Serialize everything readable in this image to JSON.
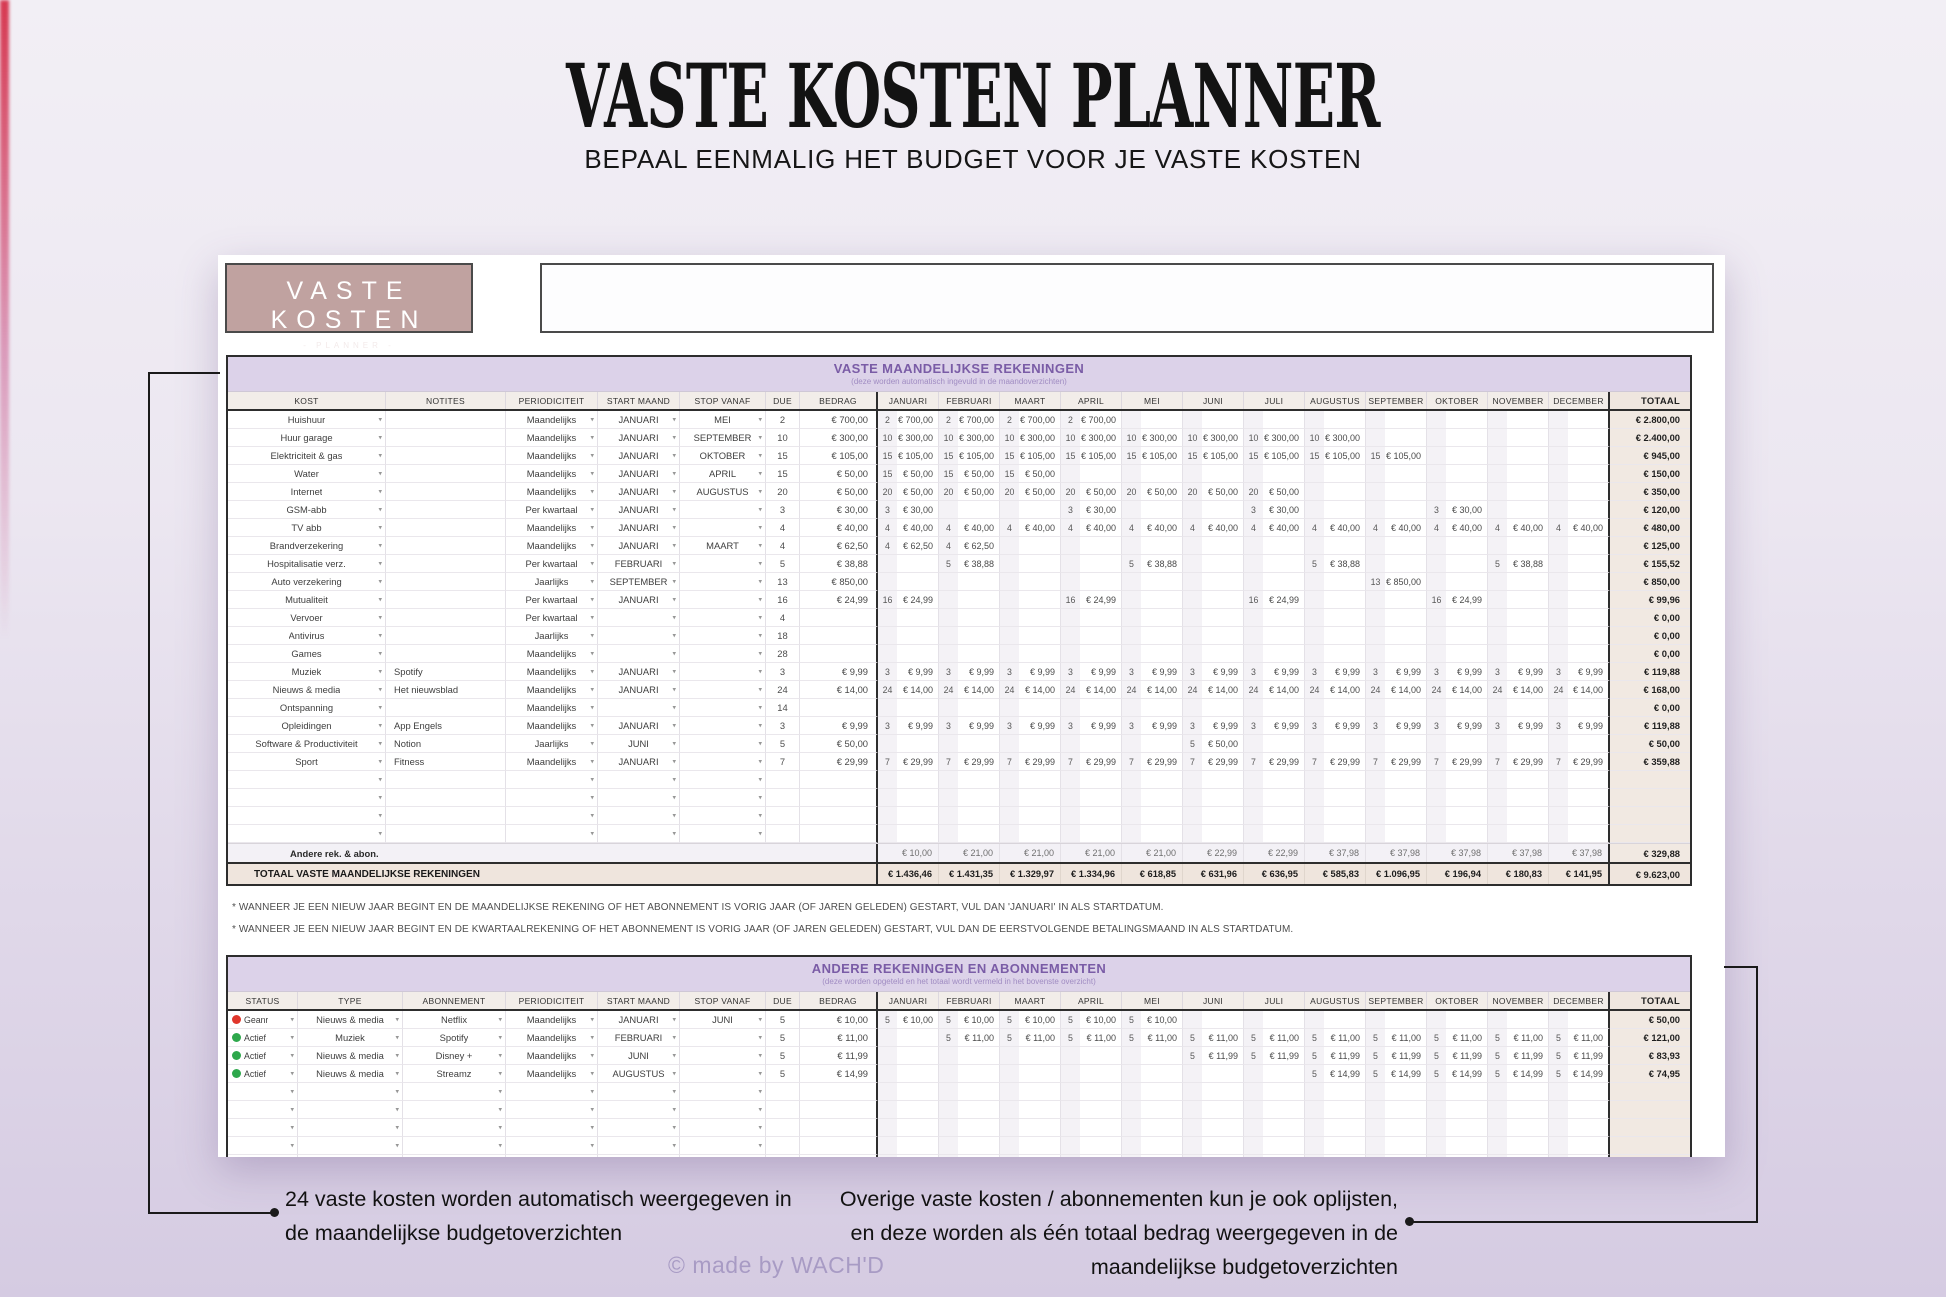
{
  "page": {
    "title": "VASTE KOSTEN PLANNER",
    "subtitle": "BEPAAL EENMALIG HET BUDGET VOOR JE VASTE KOSTEN",
    "credit": "© made by WACH'D"
  },
  "logo": {
    "title": "VASTE KOSTEN",
    "subtitle": "- PLANNER -"
  },
  "annotations": {
    "left": [
      "24 vaste kosten worden automatisch weergegeven in",
      "de maandelijkse budgetoverzichten"
    ],
    "right": [
      "Overige vaste kosten / abonnementen kun je ook oplijsten,",
      "en deze worden als één totaal bedrag weergegeven in de",
      "maandelijkse budgetoverzichten"
    ]
  },
  "footnotes": [
    "* WANNEER JE EEN NIEUW JAAR BEGINT EN DE MAANDELIJKSE REKENING OF HET ABONNEMENT IS VORIG JAAR (OF JAREN GELEDEN) GESTART, VUL DAN 'JANUARI' IN ALS STARTDATUM.",
    "* WANNEER JE EEN NIEUW JAAR BEGINT EN DE KWARTAALREKENING OF HET ABONNEMENT IS VORIG JAAR (OF JAREN GELEDEN) GESTART, VUL DAN DE EERSTVOLGENDE BETALINGSMAAND IN ALS STARTDATUM."
  ],
  "months": [
    "JANUARI",
    "FEBRUARI",
    "MAART",
    "APRIL",
    "MEI",
    "JUNI",
    "JULI",
    "AUGUSTUS",
    "SEPTEMBER",
    "OKTOBER",
    "NOVEMBER",
    "DECEMBER"
  ],
  "colors": {
    "accent_purple": "#7a5ca6",
    "band_bg": "#dcd2e9",
    "logo_rose": "#c0a2a0",
    "total_beige": "#f1e9e2",
    "status_red": "#e0372c",
    "status_green": "#2ea84c"
  },
  "table1": {
    "title": "VASTE MAANDELIJKSE REKENINGEN",
    "subtitle": "(deze worden automatisch ingevuld in de maandoverzichten)",
    "columns": [
      "KOST",
      "NOTITES",
      "PERIODICITEIT",
      "START MAAND",
      "STOP VANAF",
      "DUE",
      "BEDRAG"
    ],
    "total_column": "TOTAAL",
    "empty_rows": 4,
    "rows": [
      {
        "kost": "Huishuur",
        "notities": "",
        "periodiciteit": "Maandelijks",
        "start": "JANUARI",
        "stop": "MEI",
        "due": "2",
        "bedrag": "€ 700,00",
        "total": "€ 2.800,00",
        "months": [
          [
            "2",
            "€ 700,00"
          ],
          [
            "2",
            "€ 700,00"
          ],
          [
            "2",
            "€ 700,00"
          ],
          [
            "2",
            "€ 700,00"
          ],
          null,
          null,
          null,
          null,
          null,
          null,
          null,
          null
        ]
      },
      {
        "kost": "Huur garage",
        "notities": "",
        "periodiciteit": "Maandelijks",
        "start": "JANUARI",
        "stop": "SEPTEMBER",
        "due": "10",
        "bedrag": "€ 300,00",
        "total": "€ 2.400,00",
        "months": [
          [
            "10",
            "€ 300,00"
          ],
          [
            "10",
            "€ 300,00"
          ],
          [
            "10",
            "€ 300,00"
          ],
          [
            "10",
            "€ 300,00"
          ],
          [
            "10",
            "€ 300,00"
          ],
          [
            "10",
            "€ 300,00"
          ],
          [
            "10",
            "€ 300,00"
          ],
          [
            "10",
            "€ 300,00"
          ],
          null,
          null,
          null,
          null
        ]
      },
      {
        "kost": "Elektriciteit & gas",
        "notities": "",
        "periodiciteit": "Maandelijks",
        "start": "JANUARI",
        "stop": "OKTOBER",
        "due": "15",
        "bedrag": "€ 105,00",
        "total": "€ 945,00",
        "months": [
          [
            "15",
            "€ 105,00"
          ],
          [
            "15",
            "€ 105,00"
          ],
          [
            "15",
            "€ 105,00"
          ],
          [
            "15",
            "€ 105,00"
          ],
          [
            "15",
            "€ 105,00"
          ],
          [
            "15",
            "€ 105,00"
          ],
          [
            "15",
            "€ 105,00"
          ],
          [
            "15",
            "€ 105,00"
          ],
          [
            "15",
            "€ 105,00"
          ],
          null,
          null,
          null
        ]
      },
      {
        "kost": "Water",
        "notities": "",
        "periodiciteit": "Maandelijks",
        "start": "JANUARI",
        "stop": "APRIL",
        "due": "15",
        "bedrag": "€ 50,00",
        "total": "€ 150,00",
        "months": [
          [
            "15",
            "€ 50,00"
          ],
          [
            "15",
            "€ 50,00"
          ],
          [
            "15",
            "€ 50,00"
          ],
          null,
          null,
          null,
          null,
          null,
          null,
          null,
          null,
          null
        ]
      },
      {
        "kost": "Internet",
        "notities": "",
        "periodiciteit": "Maandelijks",
        "start": "JANUARI",
        "stop": "AUGUSTUS",
        "due": "20",
        "bedrag": "€ 50,00",
        "total": "€ 350,00",
        "months": [
          [
            "20",
            "€ 50,00"
          ],
          [
            "20",
            "€ 50,00"
          ],
          [
            "20",
            "€ 50,00"
          ],
          [
            "20",
            "€ 50,00"
          ],
          [
            "20",
            "€ 50,00"
          ],
          [
            "20",
            "€ 50,00"
          ],
          [
            "20",
            "€ 50,00"
          ],
          null,
          null,
          null,
          null,
          null
        ]
      },
      {
        "kost": "GSM-abb",
        "notities": "",
        "periodiciteit": "Per kwartaal",
        "start": "JANUARI",
        "stop": "",
        "due": "3",
        "bedrag": "€ 30,00",
        "total": "€ 120,00",
        "months": [
          [
            "3",
            "€ 30,00"
          ],
          null,
          null,
          [
            "3",
            "€ 30,00"
          ],
          null,
          null,
          [
            "3",
            "€ 30,00"
          ],
          null,
          null,
          [
            "3",
            "€ 30,00"
          ],
          null,
          null
        ]
      },
      {
        "kost": "TV abb",
        "notities": "",
        "periodiciteit": "Maandelijks",
        "start": "JANUARI",
        "stop": "",
        "due": "4",
        "bedrag": "€ 40,00",
        "total": "€ 480,00",
        "months": [
          [
            "4",
            "€ 40,00"
          ],
          [
            "4",
            "€ 40,00"
          ],
          [
            "4",
            "€ 40,00"
          ],
          [
            "4",
            "€ 40,00"
          ],
          [
            "4",
            "€ 40,00"
          ],
          [
            "4",
            "€ 40,00"
          ],
          [
            "4",
            "€ 40,00"
          ],
          [
            "4",
            "€ 40,00"
          ],
          [
            "4",
            "€ 40,00"
          ],
          [
            "4",
            "€ 40,00"
          ],
          [
            "4",
            "€ 40,00"
          ],
          [
            "4",
            "€ 40,00"
          ]
        ]
      },
      {
        "kost": "Brandverzekering",
        "notities": "",
        "periodiciteit": "Maandelijks",
        "start": "JANUARI",
        "stop": "MAART",
        "due": "4",
        "bedrag": "€ 62,50",
        "total": "€ 125,00",
        "months": [
          [
            "4",
            "€ 62,50"
          ],
          [
            "4",
            "€ 62,50"
          ],
          null,
          null,
          null,
          null,
          null,
          null,
          null,
          null,
          null,
          null
        ]
      },
      {
        "kost": "Hospitalisatie verz.",
        "notities": "",
        "periodiciteit": "Per kwartaal",
        "start": "FEBRUARI",
        "stop": "",
        "due": "5",
        "bedrag": "€ 38,88",
        "total": "€ 155,52",
        "months": [
          null,
          [
            "5",
            "€ 38,88"
          ],
          null,
          null,
          [
            "5",
            "€ 38,88"
          ],
          null,
          null,
          [
            "5",
            "€ 38,88"
          ],
          null,
          null,
          [
            "5",
            "€ 38,88"
          ],
          null
        ]
      },
      {
        "kost": "Auto verzekering",
        "notities": "",
        "periodiciteit": "Jaarlijks",
        "start": "SEPTEMBER",
        "stop": "",
        "due": "13",
        "bedrag": "€ 850,00",
        "total": "€ 850,00",
        "months": [
          null,
          null,
          null,
          null,
          null,
          null,
          null,
          null,
          [
            "13",
            "€ 850,00"
          ],
          null,
          null,
          null
        ]
      },
      {
        "kost": "Mutualiteit",
        "notities": "",
        "periodiciteit": "Per kwartaal",
        "start": "JANUARI",
        "stop": "",
        "due": "16",
        "bedrag": "€ 24,99",
        "total": "€ 99,96",
        "months": [
          [
            "16",
            "€ 24,99"
          ],
          null,
          null,
          [
            "16",
            "€ 24,99"
          ],
          null,
          null,
          [
            "16",
            "€ 24,99"
          ],
          null,
          null,
          [
            "16",
            "€ 24,99"
          ],
          null,
          null
        ]
      },
      {
        "kost": "Vervoer",
        "notities": "",
        "periodiciteit": "Per kwartaal",
        "start": "",
        "stop": "",
        "due": "4",
        "bedrag": "",
        "total": "€ 0,00",
        "months": []
      },
      {
        "kost": "Antivirus",
        "notities": "",
        "periodiciteit": "Jaarlijks",
        "start": "",
        "stop": "",
        "due": "18",
        "bedrag": "",
        "total": "€ 0,00",
        "months": []
      },
      {
        "kost": "Games",
        "notities": "",
        "periodiciteit": "Maandelijks",
        "start": "",
        "stop": "",
        "due": "28",
        "bedrag": "",
        "total": "€ 0,00",
        "months": []
      },
      {
        "kost": "Muziek",
        "notities": "Spotify",
        "periodiciteit": "Maandelijks",
        "start": "JANUARI",
        "stop": "",
        "due": "3",
        "bedrag": "€ 9,99",
        "total": "€ 119,88",
        "months": [
          [
            "3",
            "€ 9,99"
          ],
          [
            "3",
            "€ 9,99"
          ],
          [
            "3",
            "€ 9,99"
          ],
          [
            "3",
            "€ 9,99"
          ],
          [
            "3",
            "€ 9,99"
          ],
          [
            "3",
            "€ 9,99"
          ],
          [
            "3",
            "€ 9,99"
          ],
          [
            "3",
            "€ 9,99"
          ],
          [
            "3",
            "€ 9,99"
          ],
          [
            "3",
            "€ 9,99"
          ],
          [
            "3",
            "€ 9,99"
          ],
          [
            "3",
            "€ 9,99"
          ]
        ]
      },
      {
        "kost": "Nieuws & media",
        "notities": "Het nieuwsblad",
        "periodiciteit": "Maandelijks",
        "start": "JANUARI",
        "stop": "",
        "due": "24",
        "bedrag": "€ 14,00",
        "total": "€ 168,00",
        "months": [
          [
            "24",
            "€ 14,00"
          ],
          [
            "24",
            "€ 14,00"
          ],
          [
            "24",
            "€ 14,00"
          ],
          [
            "24",
            "€ 14,00"
          ],
          [
            "24",
            "€ 14,00"
          ],
          [
            "24",
            "€ 14,00"
          ],
          [
            "24",
            "€ 14,00"
          ],
          [
            "24",
            "€ 14,00"
          ],
          [
            "24",
            "€ 14,00"
          ],
          [
            "24",
            "€ 14,00"
          ],
          [
            "24",
            "€ 14,00"
          ],
          [
            "24",
            "€ 14,00"
          ]
        ]
      },
      {
        "kost": "Ontspanning",
        "notities": "",
        "periodiciteit": "Maandelijks",
        "start": "",
        "stop": "",
        "due": "14",
        "bedrag": "",
        "total": "€ 0,00",
        "months": []
      },
      {
        "kost": "Opleidingen",
        "notities": "App Engels",
        "periodiciteit": "Maandelijks",
        "start": "JANUARI",
        "stop": "",
        "due": "3",
        "bedrag": "€ 9,99",
        "total": "€ 119,88",
        "months": [
          [
            "3",
            "€ 9,99"
          ],
          [
            "3",
            "€ 9,99"
          ],
          [
            "3",
            "€ 9,99"
          ],
          [
            "3",
            "€ 9,99"
          ],
          [
            "3",
            "€ 9,99"
          ],
          [
            "3",
            "€ 9,99"
          ],
          [
            "3",
            "€ 9,99"
          ],
          [
            "3",
            "€ 9,99"
          ],
          [
            "3",
            "€ 9,99"
          ],
          [
            "3",
            "€ 9,99"
          ],
          [
            "3",
            "€ 9,99"
          ],
          [
            "3",
            "€ 9,99"
          ]
        ]
      },
      {
        "kost": "Software & Productiviteit",
        "notities": "Notion",
        "periodiciteit": "Jaarlijks",
        "start": "JUNI",
        "stop": "",
        "due": "5",
        "bedrag": "€ 50,00",
        "total": "€ 50,00",
        "months": [
          null,
          null,
          null,
          null,
          null,
          [
            "5",
            "€ 50,00"
          ],
          null,
          null,
          null,
          null,
          null,
          null
        ]
      },
      {
        "kost": "Sport",
        "notities": "Fitness",
        "periodiciteit": "Maandelijks",
        "start": "JANUARI",
        "stop": "",
        "due": "7",
        "bedrag": "€ 29,99",
        "total": "€ 359,88",
        "months": [
          [
            "7",
            "€ 29,99"
          ],
          [
            "7",
            "€ 29,99"
          ],
          [
            "7",
            "€ 29,99"
          ],
          [
            "7",
            "€ 29,99"
          ],
          [
            "7",
            "€ 29,99"
          ],
          [
            "7",
            "€ 29,99"
          ],
          [
            "7",
            "€ 29,99"
          ],
          [
            "7",
            "€ 29,99"
          ],
          [
            "7",
            "€ 29,99"
          ],
          [
            "7",
            "€ 29,99"
          ],
          [
            "7",
            "€ 29,99"
          ],
          [
            "7",
            "€ 29,99"
          ]
        ]
      }
    ],
    "andere": {
      "label": "Andere rek. & abon.",
      "values": [
        "€ 10,00",
        "€ 21,00",
        "€ 21,00",
        "€ 21,00",
        "€ 21,00",
        "€ 22,99",
        "€ 22,99",
        "€ 37,98",
        "€ 37,98",
        "€ 37,98",
        "€ 37,98",
        "€ 37,98"
      ],
      "total": "€ 329,88"
    },
    "grand": {
      "label": "TOTAAL VASTE MAANDELIJKSE REKENINGEN",
      "values": [
        "€ 1.436,46",
        "€ 1.431,35",
        "€ 1.329,97",
        "€ 1.334,96",
        "€ 618,85",
        "€ 631,96",
        "€ 636,95",
        "€ 585,83",
        "€ 1.096,95",
        "€ 196,94",
        "€ 180,83",
        "€ 141,95"
      ],
      "total": "€ 9.623,00"
    }
  },
  "table2": {
    "title": "ANDERE REKENINGEN EN ABONNEMENTEN",
    "subtitle": "(deze worden opgeteld en het totaal wordt vermeld in het bovenste overzicht)",
    "columns": [
      "STATUS",
      "TYPE",
      "ABONNEMENT",
      "PERIODICITEIT",
      "START MAAND",
      "STOP VANAF",
      "DUE",
      "BEDRAG"
    ],
    "total_column": "TOTAAL",
    "empty_rows": 6,
    "rows": [
      {
        "status": "Geanr",
        "status_color": "red",
        "type": "Nieuws & media",
        "abonnement": "Netflix",
        "periodiciteit": "Maandelijks",
        "start": "JANUARI",
        "stop": "JUNI",
        "due": "5",
        "bedrag": "€ 10,00",
        "total": "€ 50,00",
        "months": [
          [
            "5",
            "€ 10,00"
          ],
          [
            "5",
            "€ 10,00"
          ],
          [
            "5",
            "€ 10,00"
          ],
          [
            "5",
            "€ 10,00"
          ],
          [
            "5",
            "€ 10,00"
          ],
          null,
          null,
          null,
          null,
          null,
          null,
          null
        ]
      },
      {
        "status": "Actief",
        "status_color": "green",
        "type": "Muziek",
        "abonnement": "Spotify",
        "periodiciteit": "Maandelijks",
        "start": "FEBRUARI",
        "stop": "",
        "due": "5",
        "bedrag": "€ 11,00",
        "total": "€ 121,00",
        "months": [
          null,
          [
            "5",
            "€ 11,00"
          ],
          [
            "5",
            "€ 11,00"
          ],
          [
            "5",
            "€ 11,00"
          ],
          [
            "5",
            "€ 11,00"
          ],
          [
            "5",
            "€ 11,00"
          ],
          [
            "5",
            "€ 11,00"
          ],
          [
            "5",
            "€ 11,00"
          ],
          [
            "5",
            "€ 11,00"
          ],
          [
            "5",
            "€ 11,00"
          ],
          [
            "5",
            "€ 11,00"
          ],
          [
            "5",
            "€ 11,00"
          ]
        ]
      },
      {
        "status": "Actief",
        "status_color": "green",
        "type": "Nieuws & media",
        "abonnement": "Disney +",
        "periodiciteit": "Maandelijks",
        "start": "JUNI",
        "stop": "",
        "due": "5",
        "bedrag": "€ 11,99",
        "total": "€ 83,93",
        "months": [
          null,
          null,
          null,
          null,
          null,
          [
            "5",
            "€ 11,99"
          ],
          [
            "5",
            "€ 11,99"
          ],
          [
            "5",
            "€ 11,99"
          ],
          [
            "5",
            "€ 11,99"
          ],
          [
            "5",
            "€ 11,99"
          ],
          [
            "5",
            "€ 11,99"
          ],
          [
            "5",
            "€ 11,99"
          ]
        ]
      },
      {
        "status": "Actief",
        "status_color": "green",
        "type": "Nieuws & media",
        "abonnement": "Streamz",
        "periodiciteit": "Maandelijks",
        "start": "AUGUSTUS",
        "stop": "",
        "due": "5",
        "bedrag": "€ 14,99",
        "total": "€ 74,95",
        "months": [
          null,
          null,
          null,
          null,
          null,
          null,
          null,
          [
            "5",
            "€ 14,99"
          ],
          [
            "5",
            "€ 14,99"
          ],
          [
            "5",
            "€ 14,99"
          ],
          [
            "5",
            "€ 14,99"
          ],
          [
            "5",
            "€ 14,99"
          ]
        ]
      }
    ]
  }
}
